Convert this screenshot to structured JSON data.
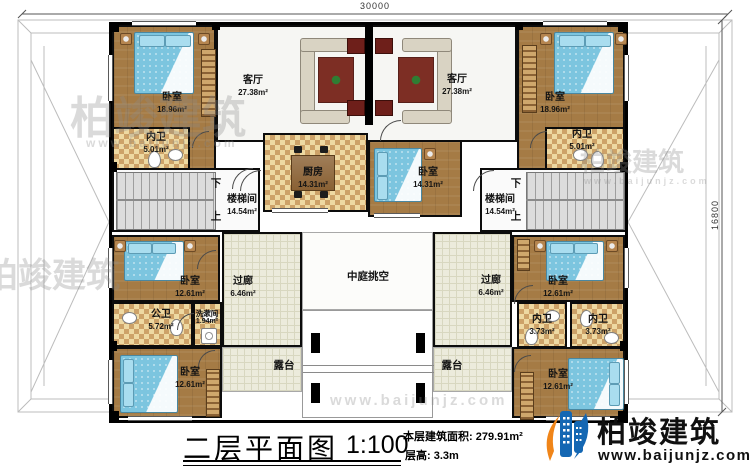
{
  "dimensions": {
    "top": "30000",
    "right": "16800"
  },
  "rooms": {
    "bedroom_tl": {
      "label": "卧室",
      "area": "18.96m²"
    },
    "bedroom_tr": {
      "label": "卧室",
      "area": "18.96m²"
    },
    "living_l": {
      "label": "客厅",
      "area": "27.38m²"
    },
    "living_r": {
      "label": "客厅",
      "area": "27.38m²"
    },
    "bath_tl": {
      "label": "内卫",
      "area": "5.01m²"
    },
    "bath_tr": {
      "label": "内卫",
      "area": "5.01m²"
    },
    "kitchen": {
      "label": "厨房",
      "area": "14.31m²"
    },
    "bedroom_c": {
      "label": "卧室",
      "area": "14.31m²"
    },
    "stair_l": {
      "label": "楼梯间",
      "area": "14.54m²",
      "down": "下",
      "up": "上"
    },
    "stair_r": {
      "label": "楼梯间",
      "area": "14.54m²",
      "down": "下",
      "up": "上"
    },
    "bedroom_ml": {
      "label": "卧室",
      "area": "12.61m²"
    },
    "bath_public": {
      "label": "公卫",
      "area": "5.72m²"
    },
    "washroom": {
      "label": "洗漱间",
      "area": "1.94m²"
    },
    "corridor_l": {
      "label": "过廊",
      "area": "6.46m²"
    },
    "corridor_r": {
      "label": "过廊",
      "area": "6.46m²"
    },
    "atrium": {
      "label": "中庭挑空"
    },
    "terrace_l": {
      "label": "露台"
    },
    "terrace_r": {
      "label": "露台"
    },
    "bedroom_mr": {
      "label": "卧室",
      "area": "12.61m²"
    },
    "bath_r1": {
      "label": "内卫",
      "area": "3.73m²"
    },
    "bath_r2": {
      "label": "内卫",
      "area": "3.73m²"
    },
    "bedroom_bl": {
      "label": "卧室",
      "area": "12.61m²"
    },
    "bedroom_br": {
      "label": "卧室",
      "area": "12.61m²"
    }
  },
  "title_block": {
    "title": "二层平面图",
    "scale": "1:100",
    "area_line": "本层建筑面积: 279.91m²",
    "height_line": "层高: 3.3m"
  },
  "brand": {
    "name": "柏竣建筑",
    "website": "www.baijunjz.com"
  },
  "watermark": {
    "name": "柏竣建筑",
    "website": "www.baijunjz.com"
  },
  "colors": {
    "wall": "#000000",
    "wood_floor": "#a57b45",
    "tile": "#eed9a2",
    "bed": "#7cc5df",
    "brand_blue": "#1467b3",
    "brand_orange": "#f08519"
  }
}
